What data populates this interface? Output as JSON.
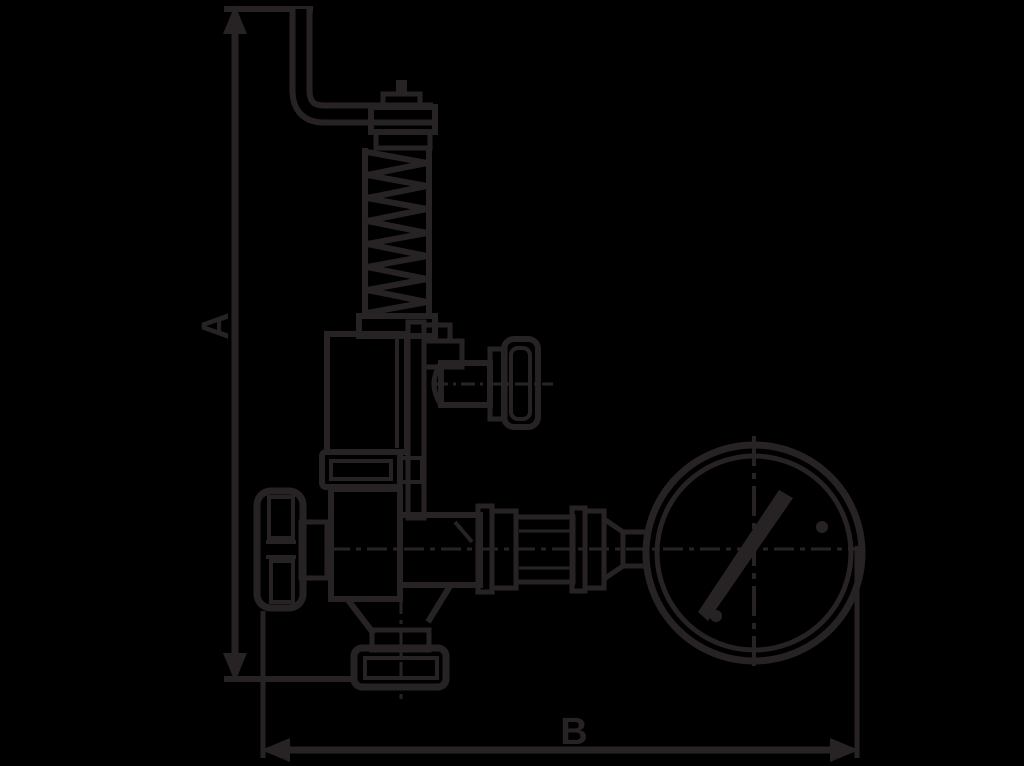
{
  "canvas": {
    "background": "#000000",
    "ink": "#272325"
  },
  "drawing": {
    "kind": "technical dimensional drawing",
    "subject": "safety relief valve with lever, handwheel and pressure gauge"
  },
  "dimensions": {
    "vertical": {
      "label": "A"
    },
    "horizontal": {
      "label": "B"
    }
  }
}
